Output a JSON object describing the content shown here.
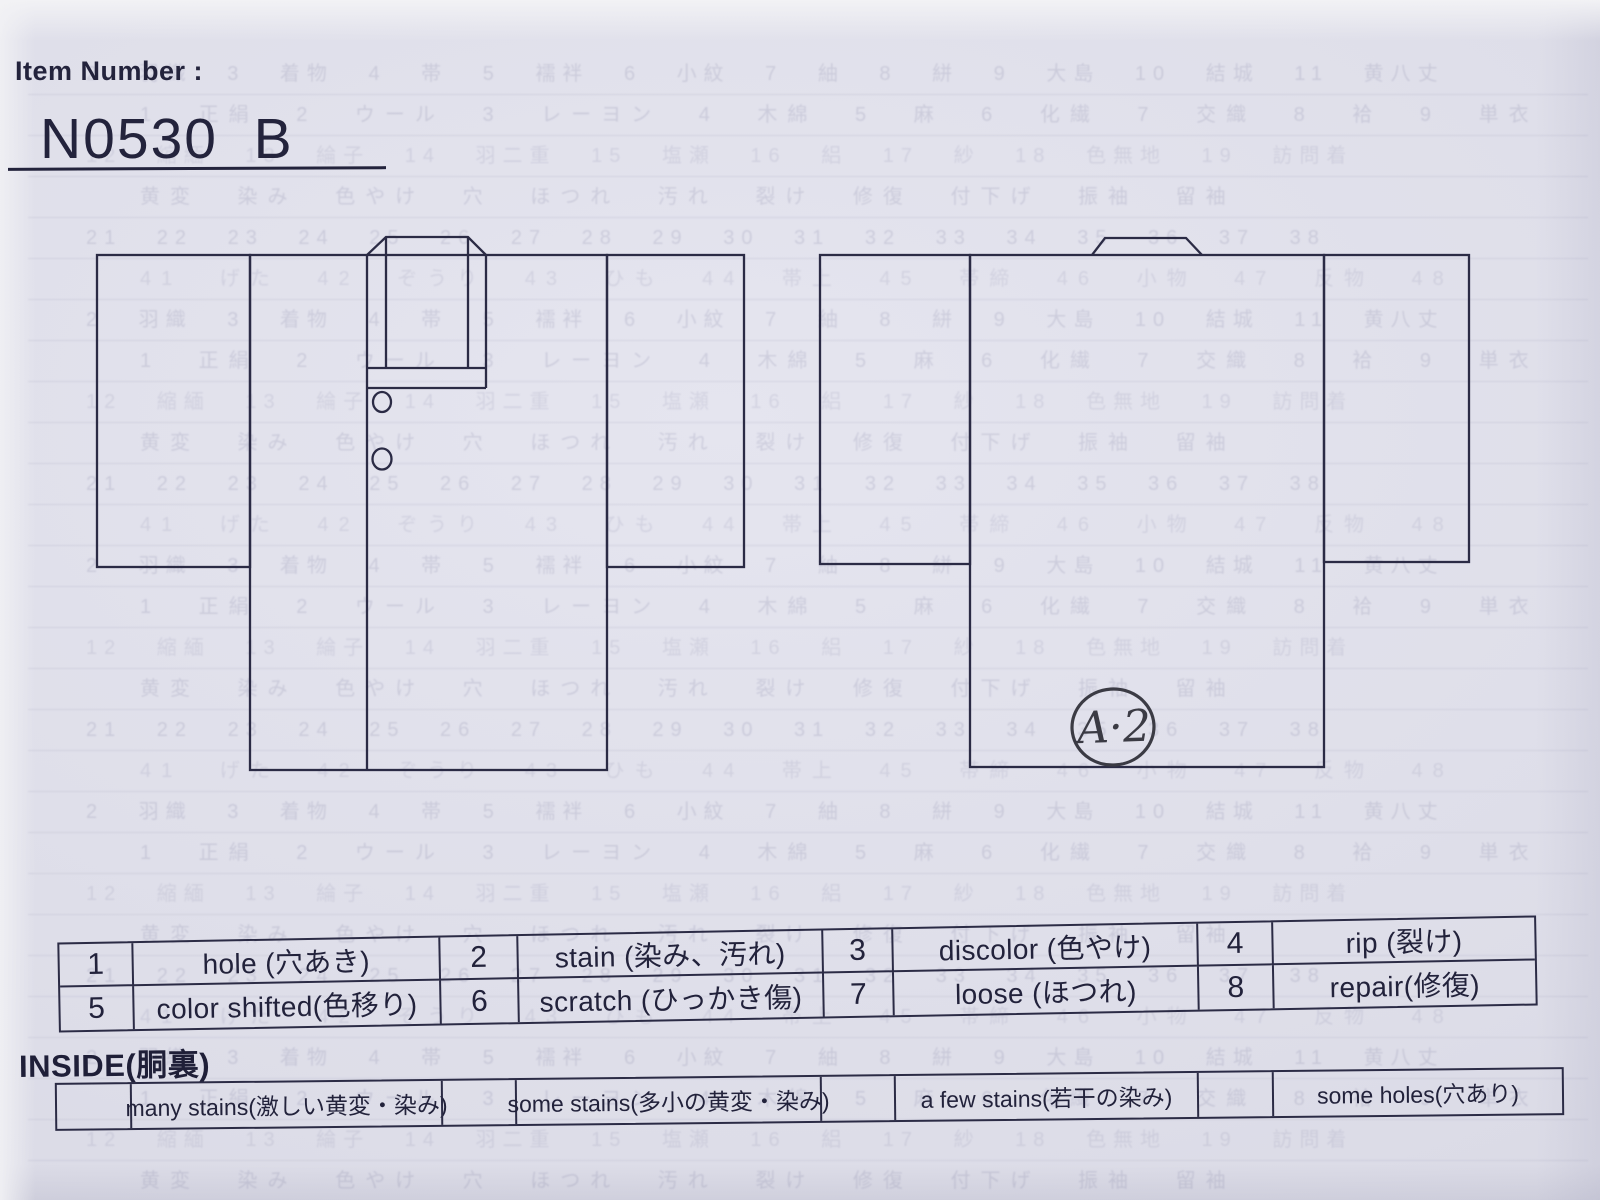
{
  "header": {
    "label": "Item Number :",
    "item_number": "N0530  B"
  },
  "diagrams": {
    "back_mark": "A·2"
  },
  "legend": {
    "rows": [
      [
        {
          "num": "1",
          "label": "hole (穴あき)"
        },
        {
          "num": "2",
          "label": "stain (染み、汚れ)"
        },
        {
          "num": "3",
          "label": "discolor (色やけ)"
        },
        {
          "num": "4",
          "label": "rip (裂け)"
        }
      ],
      [
        {
          "num": "5",
          "label": "color shifted(色移り)"
        },
        {
          "num": "6",
          "label": "scratch (ひっかき傷)"
        },
        {
          "num": "7",
          "label": "loose (ほつれ)"
        },
        {
          "num": "8",
          "label": "repair(修復)"
        }
      ]
    ]
  },
  "inside": {
    "heading": "INSIDE(胴裏)",
    "options": [
      "many stains(激しい黄変・染み)",
      "some stains(多小の黄変・染み)",
      "a few stains(若干の染み)",
      "some holes(穴あり)"
    ]
  },
  "colors": {
    "paper": "#dfdfe9",
    "ink": "#23233c",
    "diagram_line": "#2b2b45",
    "handwriting": "#3b3b44"
  },
  "ghost": {
    "rows": 29,
    "lines": [
      "2 羽織 3 着物 4 帯 5 襦袢 6 小紋 7 紬 8 絣 9 大島 10 結城 11 黄八丈",
      "1 正絹 2 ウール 3 レーヨン 4 木綿 5 麻 6 化繊 7 交織 8 袷 9 単衣",
      "12 縮緬 13 綸子 14 羽二重 15 塩瀬 16 絽 17 紗 18 色無地 19 訪問着",
      "黄変 染み 色やけ 穴 ほつれ 汚れ 裂け 修復 付下げ 振袖 留袖",
      "21 22 23 24 25 26 27 28 29 30 31 32 33 34 35 36 37 38",
      "41 げた 42 ぞうり 43 ひも 44 帯上 45 帯締 46 小物 47 反物 48"
    ]
  }
}
